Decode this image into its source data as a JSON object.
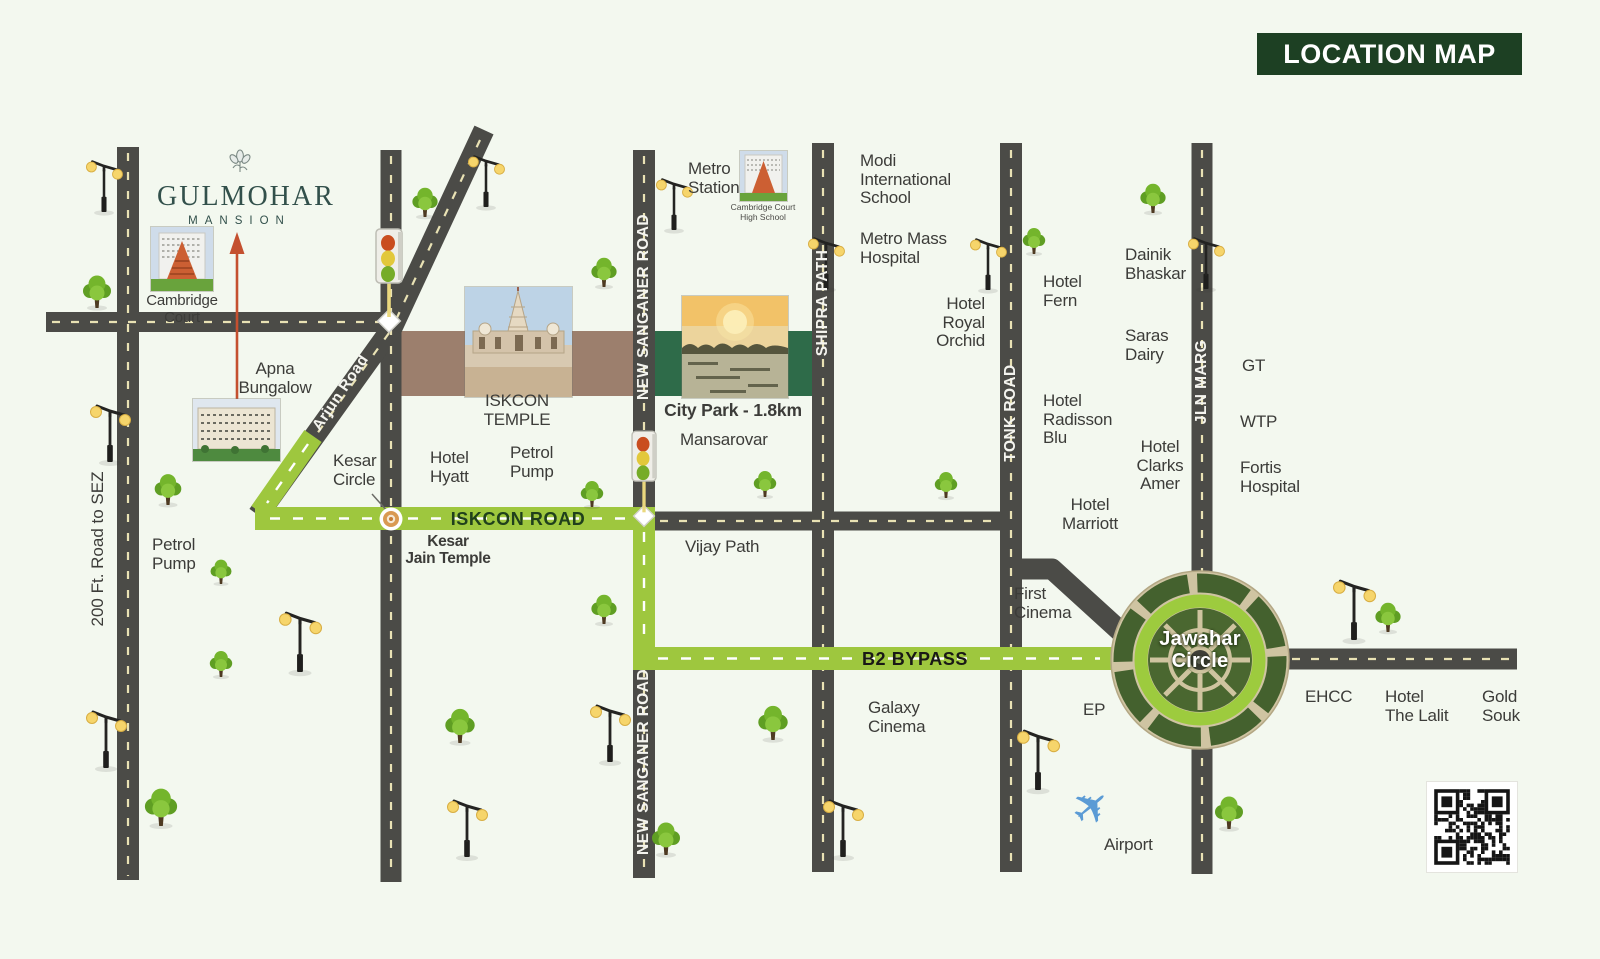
{
  "badge": {
    "title": "LOCATION MAP"
  },
  "logo": {
    "name": "GULMOHAR",
    "subtitle": "MANSION"
  },
  "roads": {
    "sez": "200 Ft. Road to SEZ",
    "arjun": "Arjun Road",
    "iskcon": "ISKCON ROAD",
    "b2": "B2 BYPASS",
    "new_sanganer": "NEW SANGANER ROAD",
    "shipra": "SHIPRA PATH",
    "tonk": "TONK ROAD",
    "jln": "JLN MARG"
  },
  "places": {
    "cambridge_court": "Cambridge\nCourt",
    "apna_bungalow": "Apna\nBungalow",
    "petrol_pump_left": "Petrol\nPump",
    "kesar_circle": "Kesar\nCircle",
    "kesar_jain_temple": "Kesar\nJain Temple",
    "hotel_hyatt": "Hotel\nHyatt",
    "petrol_pump_mid": "Petrol\nPump",
    "iskcon_temple": "ISKCON\nTEMPLE",
    "metro_station": "Metro\nStation",
    "cchs": "Cambridge Court\nHigh School",
    "city_park": "City Park - 1.8km",
    "mansarovar": "Mansarovar",
    "vijay_path": "Vijay Path",
    "modi_school": "Modi\nInternational\nSchool",
    "metro_mass": "Metro Mass\nHospital",
    "hotel_royal_orchid": "Hotel\nRoyal\nOrchid",
    "hotel_fern": "Hotel\nFern",
    "dainik_bhaskar": "Dainik\nBhaskar",
    "saras_dairy": "Saras\nDairy",
    "hotel_radisson": "Hotel\nRadisson\nBlu",
    "hotel_clarks": "Hotel\nClarks\nAmer",
    "hotel_marriott": "Hotel\nMarriott",
    "first_cinema": "First\nCinema",
    "gt": "GT",
    "wtp": "WTP",
    "fortis": "Fortis\nHospital",
    "jawahar_circle": "Jawahar\nCircle",
    "ehcc": "EHCC",
    "hotel_lalit": "Hotel\nThe Lalit",
    "gold_souk": "Gold\nSouk",
    "galaxy_cinema": "Galaxy\nCinema",
    "ep": "EP",
    "airport": "Airport"
  },
  "icons": {
    "plane_icon": "✈"
  },
  "colors": {
    "badge_bg": "#1d4023",
    "route_green": "#9ec73e",
    "road_gray": "#4b4b47",
    "band_brown": "#9c7f6d",
    "band_green": "#2e6b49",
    "arrow_red": "#c4502f",
    "plane_blue": "#5b9bd5",
    "logo_teal": "#32504b",
    "background": "#f3f8ef"
  }
}
